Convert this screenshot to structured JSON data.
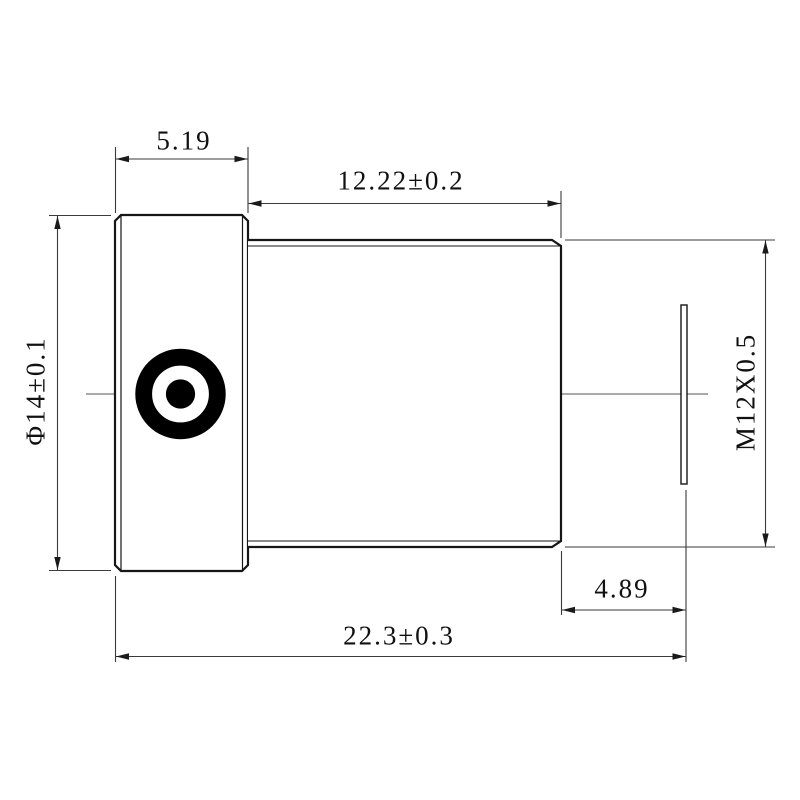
{
  "page": {
    "background": "#ffffff",
    "outline_color": "#161616",
    "dimension_line_color": "#3a3a3a",
    "centerline_color": "#555555"
  },
  "dimensions": {
    "flange_width": "5.19",
    "thread_length": "12.22±0.2",
    "flange_diameter": "Φ14±0.1",
    "thread_spec": "M12X0.5",
    "back_distance": "4.89",
    "total_length": "22.3±0.3"
  }
}
